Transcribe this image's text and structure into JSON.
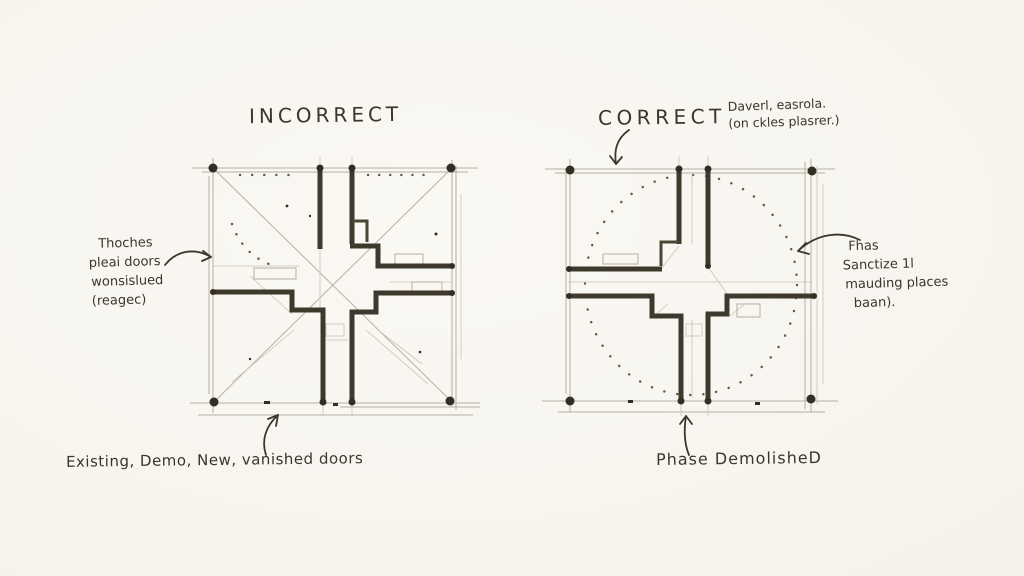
{
  "page": {
    "description": "hand-drawn architectural plan comparison sketch",
    "paper_color": "#f7f4ee",
    "ink_color": "#3a362c",
    "pencil_color": "#b6b0a3"
  },
  "left_panel": {
    "title": "INCORRECT",
    "side_note": {
      "lines": [
        "Thoches",
        "pleai doors",
        "wonsislued",
        "(reagec)"
      ]
    },
    "caption": "Existing, Demo, New, vanished doors"
  },
  "right_panel": {
    "title": "CORRECT",
    "top_note": {
      "lines": [
        "Daverl, easrola.",
        "(on ckles plasrer.)"
      ]
    },
    "side_note": {
      "lines": [
        "Fhas",
        "Sanctize 1l",
        "mauding places",
        "baan)."
      ]
    },
    "caption": "Phase DemolisheD"
  }
}
